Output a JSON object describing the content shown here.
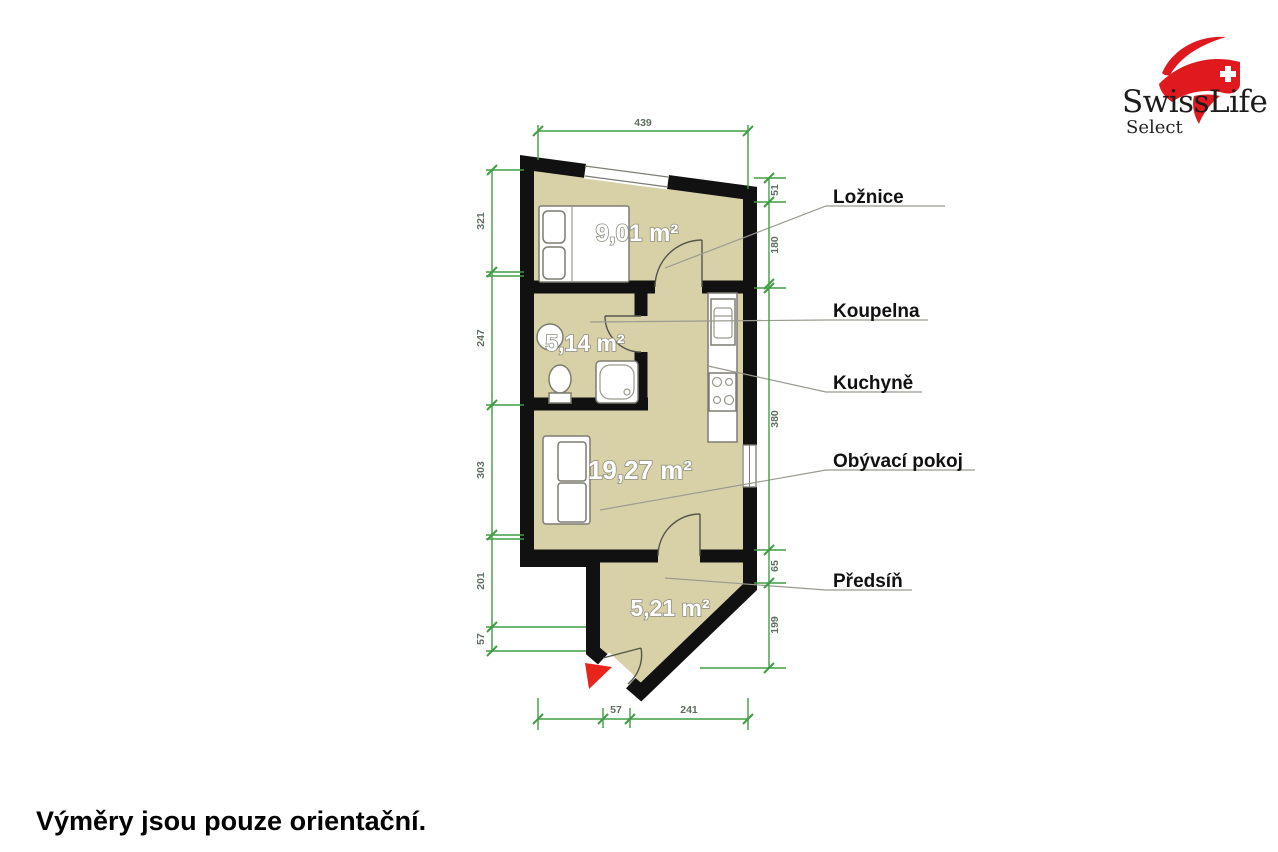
{
  "header": {
    "brand": "SwissLife",
    "brand_sub": "Select"
  },
  "footer": {
    "disclaimer": "Výměry jsou pouze orientační."
  },
  "rooms": {
    "loznice": {
      "label": "Ložnice",
      "area": "9,01 m²"
    },
    "koupelna": {
      "label": "Koupelna",
      "area": "5,14 m²"
    },
    "kuchyne": {
      "label": "Kuchyně"
    },
    "obyvaci_pokoj": {
      "label": "Obývací pokoj",
      "area": "19,27 m²"
    },
    "predsin": {
      "label": "Předsíň",
      "area": "5,21 m²"
    }
  },
  "dimensions_cm": {
    "top": {
      "d1": "439"
    },
    "left": {
      "d1": "321",
      "d2": "247",
      "d3": "303",
      "d4": "201",
      "d5": "57"
    },
    "right": {
      "d1": "51",
      "d2": "180",
      "d3": "380",
      "d4": "65",
      "d5": "199"
    },
    "bottom": {
      "d1": "57",
      "d2": "241"
    }
  },
  "colors": {
    "floor": "#d8d1a7",
    "wall": "#111111",
    "dimension_green": "#3f9d44",
    "brand_red": "#e0191f",
    "entrance_arrow_red": "#e8241d"
  }
}
